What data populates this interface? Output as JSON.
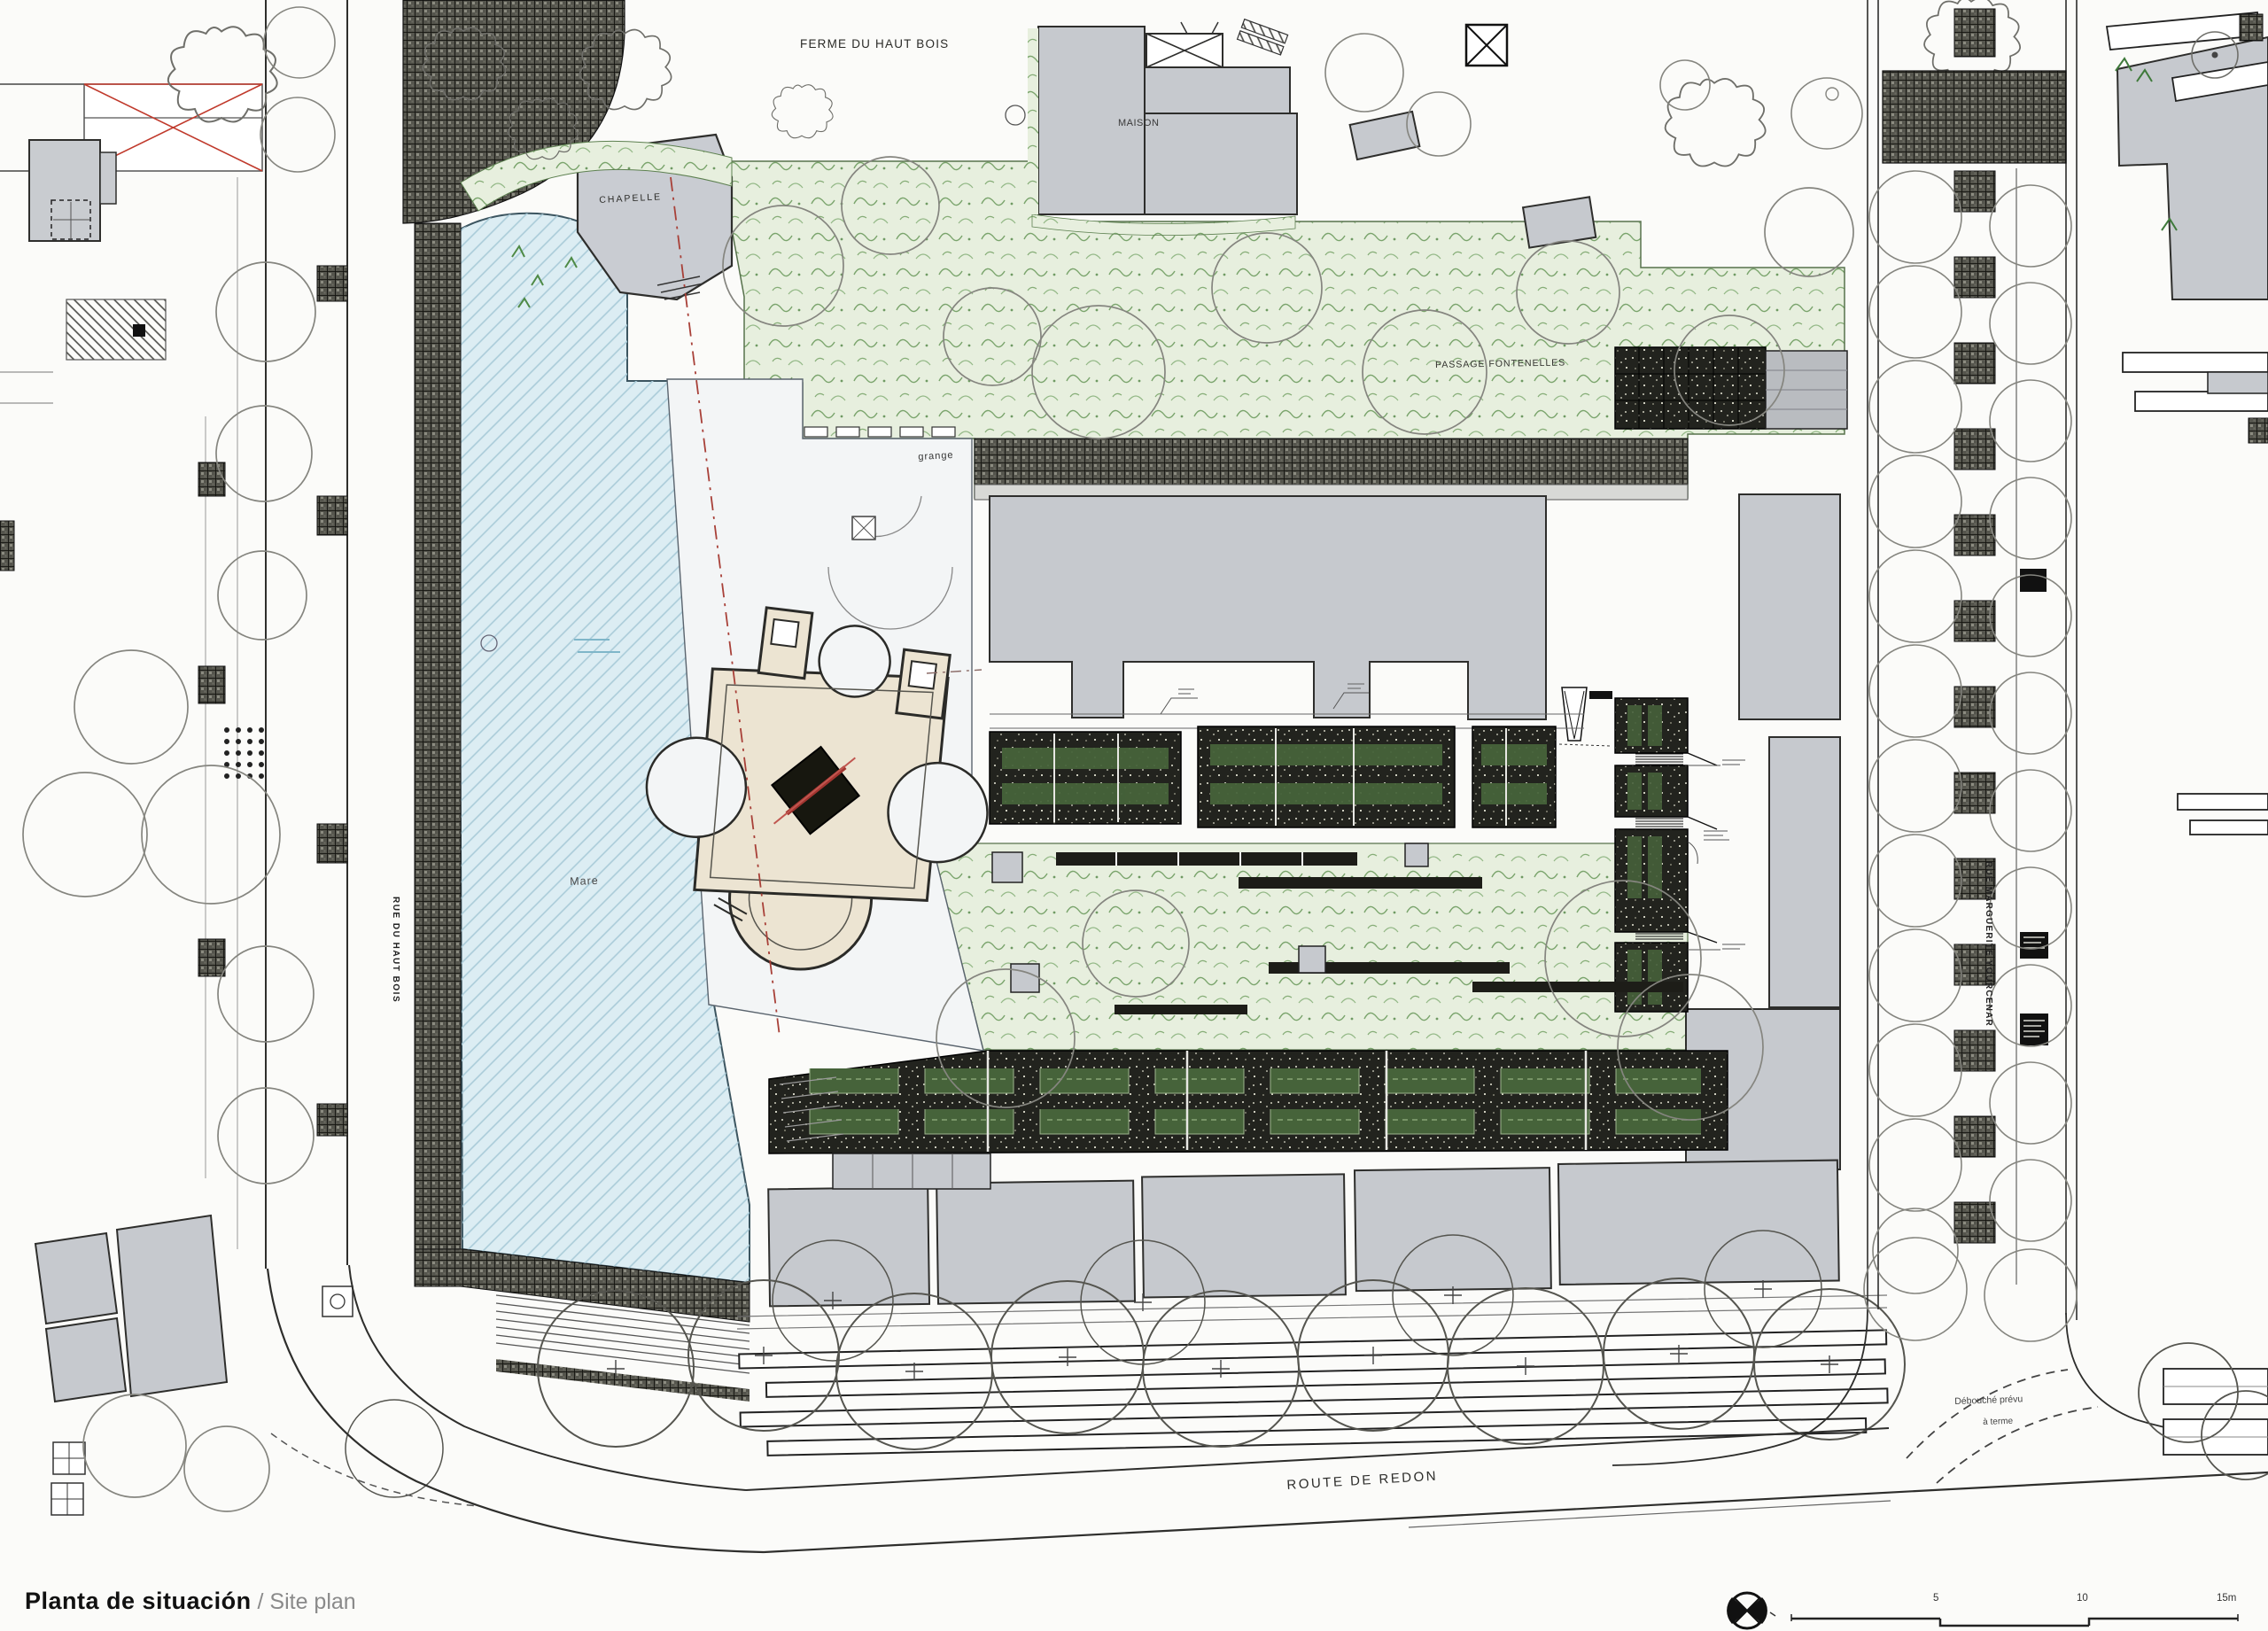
{
  "sheet": {
    "title_primary": "Planta de situación",
    "title_separator": " / ",
    "title_secondary": "Site plan"
  },
  "map_labels": {
    "farm": "FERME DU HAUT BOIS",
    "house": "MAISON",
    "chapel": "CHAPELLE",
    "barn": "grange",
    "passage": "PASSAGE FONTENELLES",
    "pond": "Mare",
    "street_west": "RUE DU HAUT BOIS",
    "street_east": "RUE MARGUERITE YOURCENAR",
    "road_south": "ROUTE DE REDON",
    "note_future_line1": "Débouché prévu",
    "note_future_line2": "à terme"
  },
  "scale_bar": {
    "tick_5": "5",
    "tick_10": "10",
    "tick_15": "15m"
  },
  "icons": {
    "north_arrow": "north-arrow-icon"
  },
  "colors": {
    "paper": "#fbfbf9",
    "building_gray": "#c6c9ce",
    "pond_blue": "#dcedf3",
    "vegetation_green": "#e7efde",
    "paving_dark": "#3a3a34",
    "castle_beige": "#ece4d2",
    "accent_red": "#b23a33"
  }
}
